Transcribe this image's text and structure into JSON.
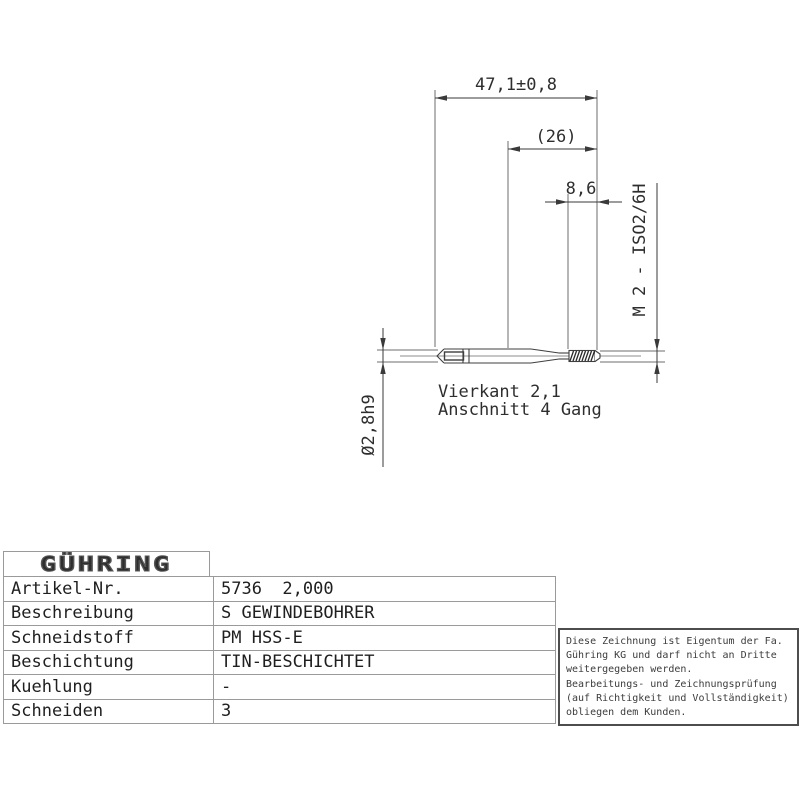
{
  "drawing": {
    "dim_overall_length": "47,1±0,8",
    "dim_shank_length": "(26)",
    "dim_thread_length": "8,6",
    "thread_spec": "M 2 - ISO2/6H",
    "shank_diameter": "Ø2,8h9",
    "square_note": "Vierkant 2,1",
    "chamfer_note": "Anschnitt 4 Gang"
  },
  "logo": {
    "text": "GÜHRING"
  },
  "spec_table": {
    "rows": [
      {
        "label": "Artikel-Nr.",
        "value": "5736  2,000"
      },
      {
        "label": "Beschreibung",
        "value": "S GEWINDEBOHRER"
      },
      {
        "label": "Schneidstoff",
        "value": "PM HSS-E"
      },
      {
        "label": "Beschichtung",
        "value": "TIN-BESCHICHTET"
      },
      {
        "label": "Kuehlung",
        "value": "-"
      },
      {
        "label": "Schneiden",
        "value": "3"
      }
    ]
  },
  "disclaimer": {
    "lines": [
      "Diese Zeichnung ist Eigentum der Fa.",
      "Gühring KG und darf nicht an Dritte",
      "weitergegeben werden.",
      "Bearbeitungs- und Zeichnungsprüfung",
      "(auf Richtigkeit und Vollständigkeit)",
      "obliegen dem Kunden."
    ]
  },
  "colors": {
    "line": "#3a3a3a",
    "extension_line": "#6e6e6e",
    "table_border": "#9a9a9a",
    "box_border": "#4d4d4d",
    "text": "#1f1f1f"
  }
}
